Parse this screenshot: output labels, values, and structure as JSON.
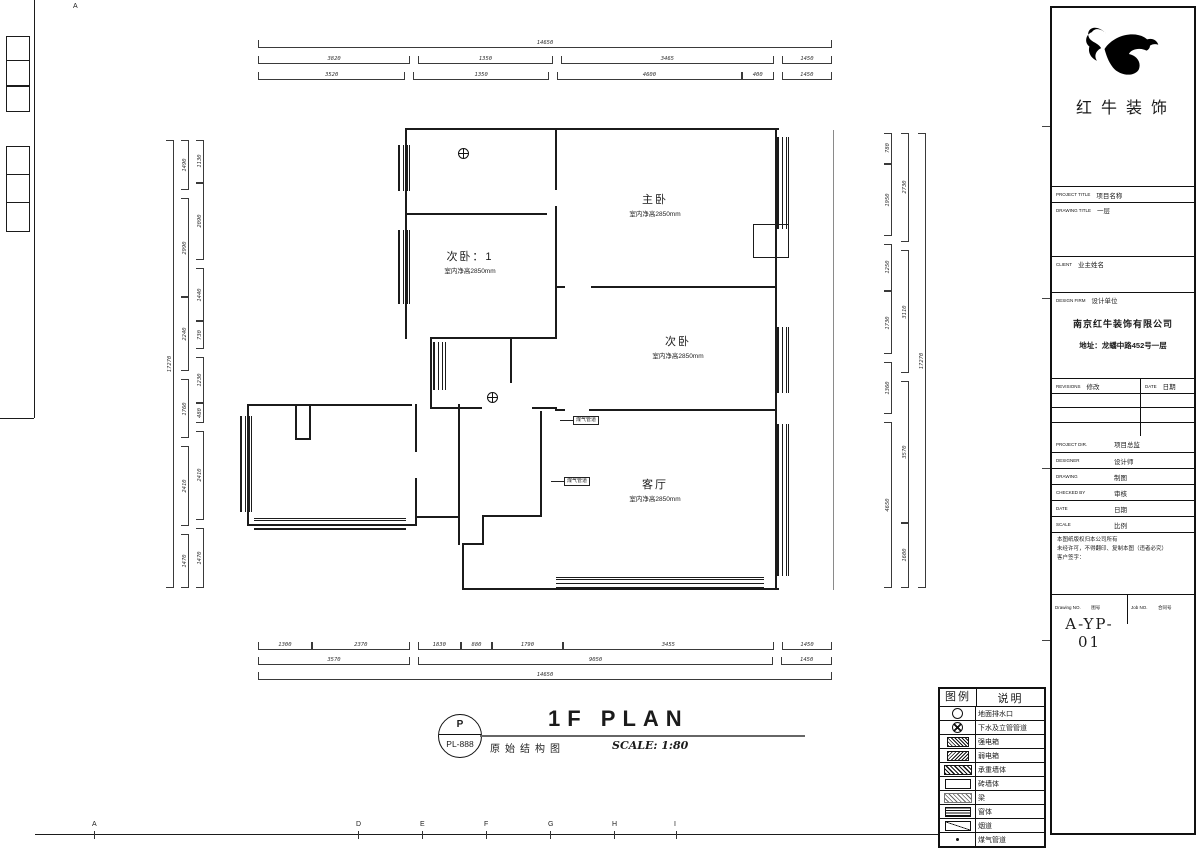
{
  "sheet": {
    "top_letter": "A",
    "grid_letters": [
      {
        "t": "A",
        "x": 92
      },
      {
        "t": "D",
        "x": 356
      },
      {
        "t": "E",
        "x": 420
      },
      {
        "t": "F",
        "x": 484
      },
      {
        "t": "G",
        "x": 548
      },
      {
        "t": "H",
        "x": 612
      },
      {
        "t": "I",
        "x": 674
      }
    ]
  },
  "plan": {
    "rooms": [
      {
        "name": "主卧",
        "sub": "室内净高2850mm"
      },
      {
        "name": "次卧：1",
        "sub": "室内净高2850mm"
      },
      {
        "name": "次卧",
        "sub": "室内净高2850mm"
      },
      {
        "name": "客厅",
        "sub": "室内净高2850mm"
      }
    ],
    "annotations": [
      "煤气管道",
      "煤气管道"
    ]
  },
  "dims": {
    "top1": [
      {
        "v": "14650",
        "w": 574
      }
    ],
    "top2": [
      {
        "v": "3820",
        "w": 153
      },
      {
        "v": "1350",
        "w": 135,
        "g": 1
      },
      {
        "v": "3465",
        "w": 215,
        "g": 1
      },
      {
        "v": "1450",
        "w": 49,
        "g": 1
      }
    ],
    "top3": [
      {
        "v": "3520",
        "w": 147
      },
      {
        "v": "1350",
        "w": 135,
        "g": 1
      },
      {
        "v": "4600",
        "w": 185,
        "g": 1
      },
      {
        "v": "400",
        "w": 30
      },
      {
        "v": "1450",
        "w": 49,
        "g": 1
      }
    ],
    "bottom1": [
      {
        "v": "1300",
        "w": 53
      },
      {
        "v": "2370",
        "w": 98
      },
      {
        "v": "1830",
        "w": 42,
        "g": 1
      },
      {
        "v": "880",
        "w": 30
      },
      {
        "v": "1790",
        "w": 70
      },
      {
        "v": "3455",
        "w": 214
      },
      {
        "v": "1450",
        "w": 49,
        "g": 1
      }
    ],
    "bottom2": [
      {
        "v": "3570",
        "w": 151
      },
      {
        "v": "9050",
        "w": 356,
        "g": 1
      },
      {
        "v": "1450",
        "w": 49,
        "g": 1
      }
    ],
    "bottom3": [
      {
        "v": "14650",
        "w": 574
      }
    ],
    "left_outer": [
      {
        "v": "17270",
        "w": 448
      }
    ],
    "left_mid": [
      {
        "v": "1490",
        "w": 46
      },
      {
        "v": "2990",
        "w": 92,
        "g": 1
      },
      {
        "v": "2240",
        "w": 69
      },
      {
        "v": "1760",
        "w": 54,
        "g": 1
      },
      {
        "v": "2410",
        "w": 74,
        "g": 1
      },
      {
        "v": "1470",
        "w": 50,
        "g": 1
      }
    ],
    "left_inner": [
      {
        "v": "1130",
        "w": 35
      },
      {
        "v": "2090",
        "w": 64
      },
      {
        "v": "1440",
        "w": 44,
        "g": 1
      },
      {
        "v": "730",
        "w": 22
      },
      {
        "v": "1230",
        "w": 38,
        "g": 1
      },
      {
        "v": "480",
        "w": 15
      },
      {
        "v": "2410",
        "w": 74,
        "g": 1
      },
      {
        "v": "1470",
        "w": 50,
        "g": 1
      }
    ],
    "right_inner": [
      {
        "v": "780",
        "w": 28
      },
      {
        "v": "1950",
        "w": 68
      },
      {
        "v": "1250",
        "w": 44,
        "g": 1
      },
      {
        "v": "1730",
        "w": 60
      },
      {
        "v": "1360",
        "w": 48,
        "g": 1
      },
      {
        "v": "4650",
        "w": 160,
        "g": 1
      }
    ],
    "right_mid": [
      {
        "v": "2730",
        "w": 95
      },
      {
        "v": "3110",
        "w": 108,
        "g": 1
      },
      {
        "v": "3570",
        "w": 124,
        "g": 1
      },
      {
        "v": "1600",
        "w": 56
      }
    ],
    "right_outer": [
      {
        "v": "17270",
        "w": 455
      }
    ]
  },
  "footer": {
    "stamp_top": "P",
    "stamp_no": "PL-888",
    "drawing_name": "原始结构图",
    "title": "1F PLAN",
    "scale": "SCALE: 1:80"
  },
  "legend": {
    "header_sym": "图例",
    "header_desc": "说明",
    "rows": [
      {
        "sym": "circle",
        "label": "地面排水口"
      },
      {
        "sym": "circlex",
        "label": "下水及立管管道"
      },
      {
        "sym": "boxstrong",
        "label": "强电箱"
      },
      {
        "sym": "boxweak",
        "label": "弱电箱"
      },
      {
        "sym": "hatchdense",
        "label": "承重墙体"
      },
      {
        "sym": "rectempty",
        "label": "砖墙体"
      },
      {
        "sym": "hatchdiag",
        "label": "梁"
      },
      {
        "sym": "stripes",
        "label": "窗体"
      },
      {
        "sym": "rectdiag",
        "label": "烟道"
      },
      {
        "sym": "dot",
        "label": "煤气管道"
      }
    ]
  },
  "titleblock": {
    "company": "红牛装饰",
    "project_label": "PROJECT TITLE",
    "project_value": "项目名称",
    "drawing_label": "DRAWING TITLE",
    "drawing_value": "一层",
    "client_label": "CLIENT",
    "client_value": "业主姓名",
    "firm_label": "DESIGN FIRM",
    "firm_value": "设计单位",
    "firm_name": "南京红牛装饰有限公司",
    "firm_addr": "地址：龙蟠中路452号一层",
    "revisions_label": "REVISIONS",
    "revisions_cn": "修改",
    "date_label": "DATE",
    "date_cn": "日期",
    "staff_rows": [
      {
        "en": "PROJECT DIR.",
        "cn": "项目总监"
      },
      {
        "en": "DESIGNER",
        "cn": "设计师"
      },
      {
        "en": "DRAWING",
        "cn": "制图"
      },
      {
        "en": "CHECKED BY",
        "cn": "审核"
      },
      {
        "en": "DATE",
        "cn": "日期"
      },
      {
        "en": "SCALE",
        "cn": "比例"
      }
    ],
    "notes": [
      "本图纸版权归本公司所有",
      "未经许可，不得翻印、复制本图（违者必究）",
      "客户签字："
    ],
    "dwg_no_label": "Drawing NO.",
    "dwg_no_cn": "图号",
    "dwg_no": "A-YP-01",
    "job_label": "Job NO.",
    "job_cn": "合同号"
  }
}
